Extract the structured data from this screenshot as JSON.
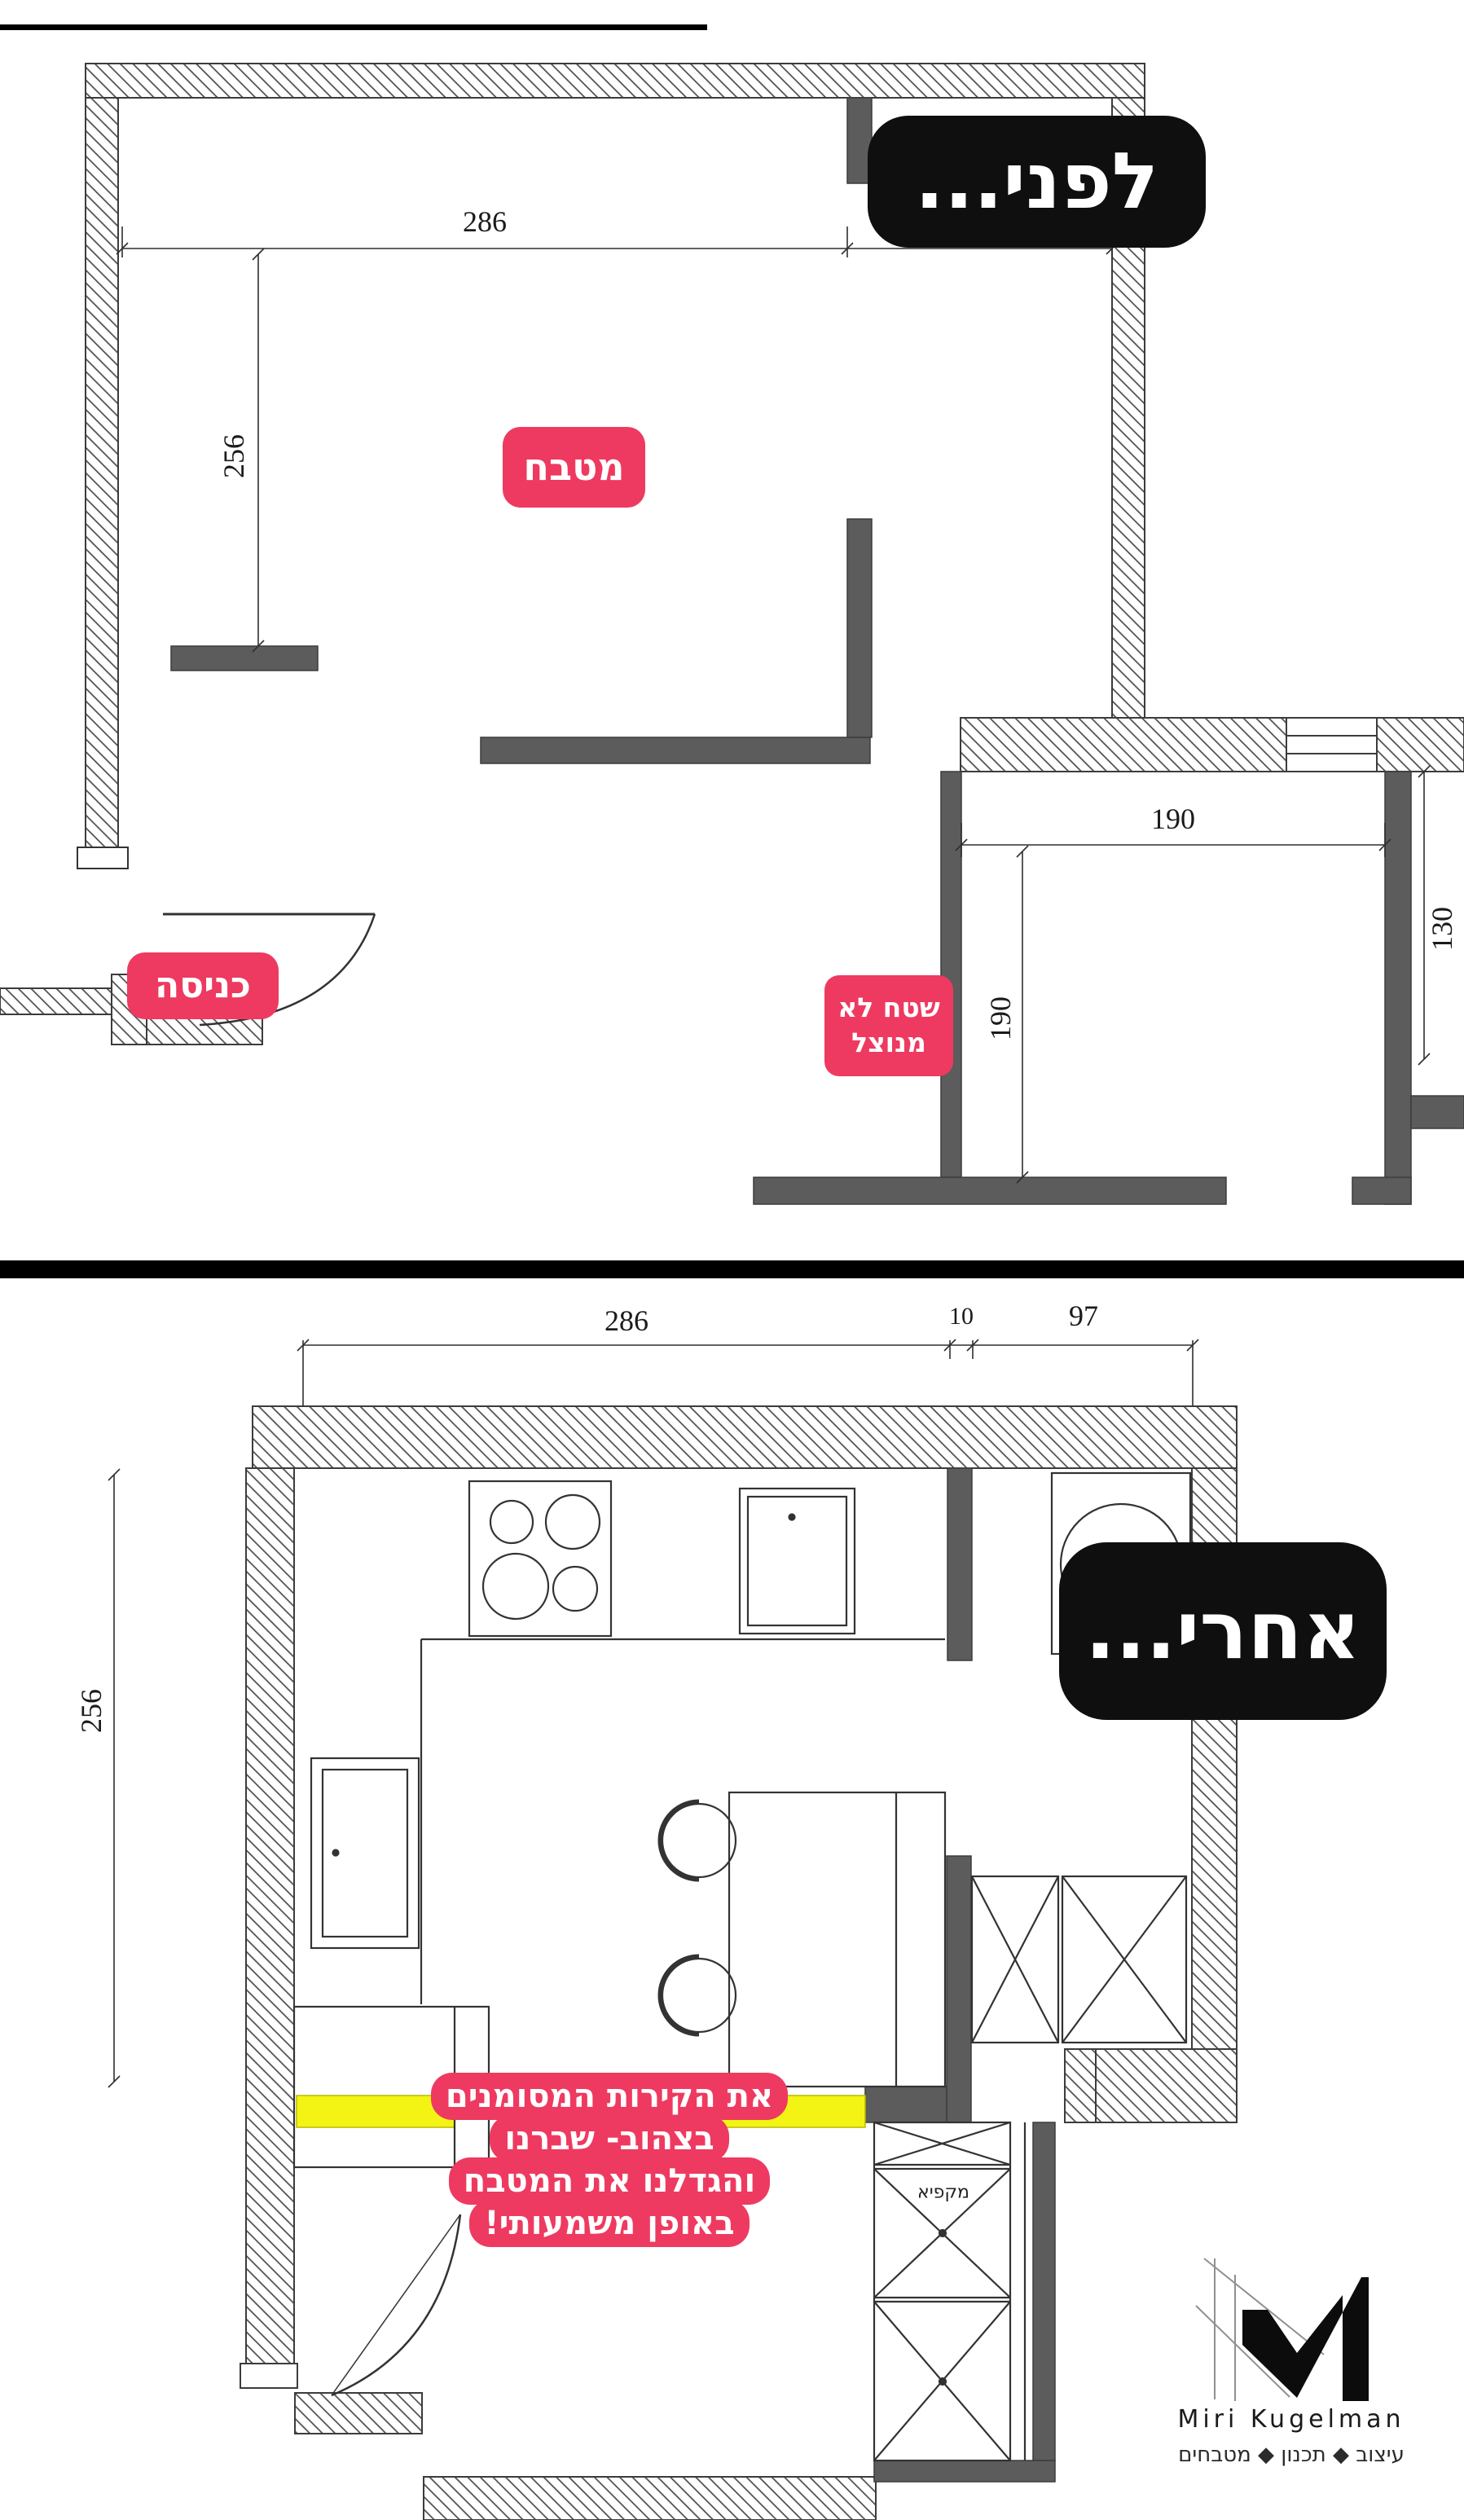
{
  "before_plan": {
    "stage_label": "לפני...",
    "kitchen_label": "מטבח",
    "entrance_label": "כניסה",
    "unused_label_line1": "שטח לא",
    "unused_label_line2": "מנוצל",
    "dims": {
      "top_width": "286",
      "top_right": "97",
      "left_height": "256",
      "room_width": "190",
      "room_height": "190",
      "room_side": "130"
    }
  },
  "after_plan": {
    "stage_label": "אחרי...",
    "dims": {
      "top_width": "286",
      "top_gap": "10",
      "top_right": "97",
      "left_height": "256"
    },
    "cabinet_label": "מקפיא",
    "note_lines": [
      "את הקירות המסומנים",
      "בצהוב- שברנו",
      "והגדלנו את המטבח",
      "באופן משמעותי!"
    ]
  },
  "logo": {
    "name": "Miri Kugelman",
    "tagline": "עיצוב ◆ תכנון ◆ מטבחים"
  },
  "colors": {
    "pink": "#ee3a60",
    "yellow": "#f4f414",
    "badge_black": "#0f0f0f",
    "wall_gray": "#5c5c5c",
    "line": "#2f2f2f"
  }
}
